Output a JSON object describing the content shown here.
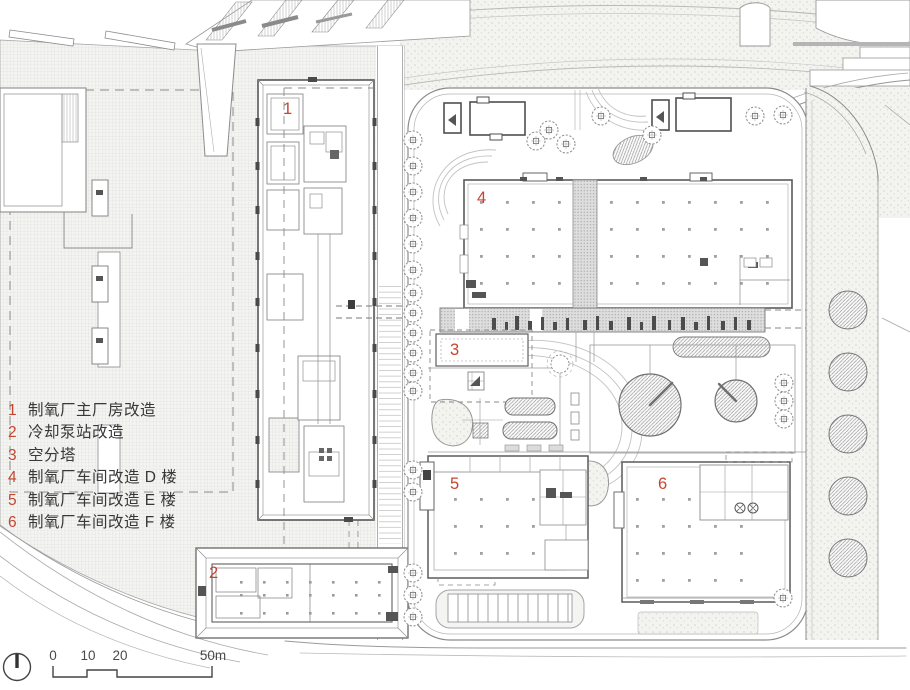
{
  "legend": {
    "items": [
      {
        "num": "1",
        "label": "制氧厂主厂房改造"
      },
      {
        "num": "2",
        "label": "冷却泵站改造"
      },
      {
        "num": "3",
        "label": "空分塔"
      },
      {
        "num": "4",
        "label": "制氧厂车间改造 D 楼"
      },
      {
        "num": "5",
        "label": "制氧厂车间改造 E 楼"
      },
      {
        "num": "6",
        "label": "制氧厂车间改造 F 楼"
      }
    ]
  },
  "plan": {
    "markers": [
      "1",
      "2",
      "3",
      "4",
      "5",
      "6"
    ]
  },
  "scalebar": {
    "labels": [
      "0",
      "10",
      "20",
      "50m"
    ]
  },
  "colors": {
    "marker_red": "#c4462f",
    "line_dark": "#5a5a5a",
    "line_mid": "#8c8c8c",
    "line_light": "#b5b5b5",
    "hatch_bg": "#f3f3f1"
  }
}
